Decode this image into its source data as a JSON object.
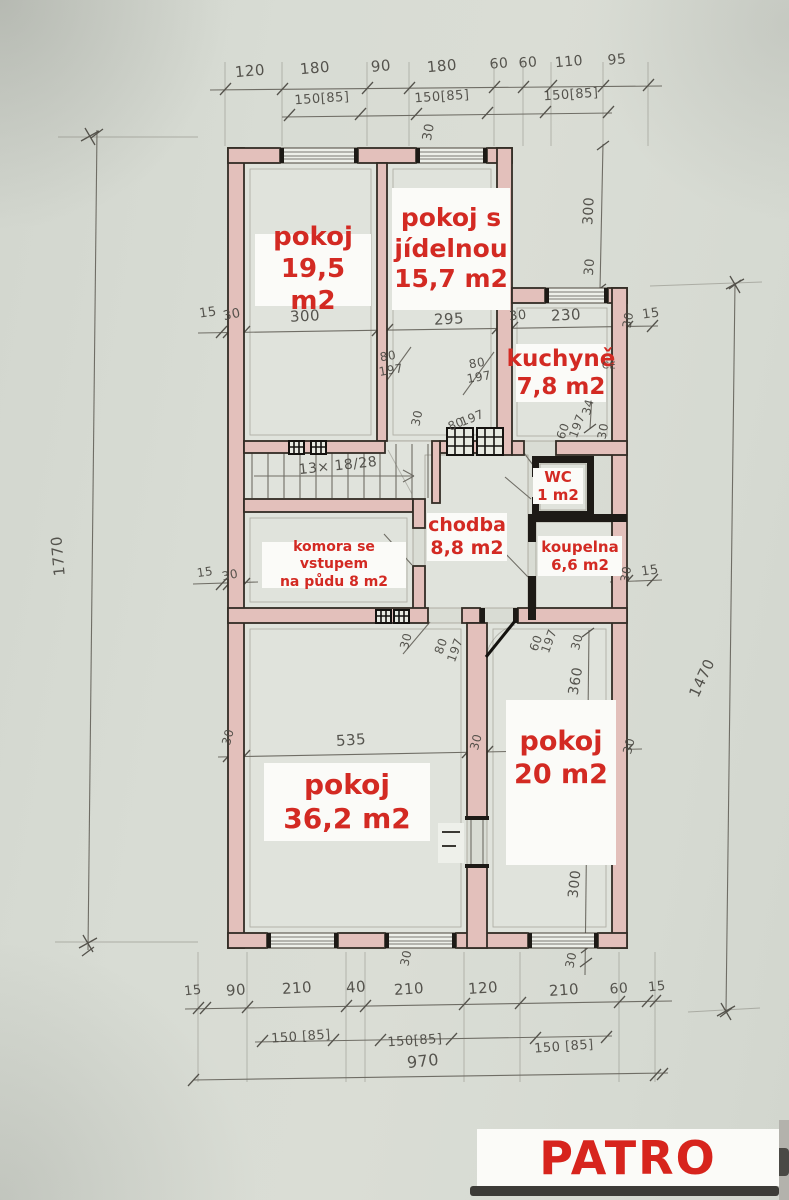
{
  "title": "PATRO",
  "accent_color": "#d32a23",
  "paper_color": "#d6dad2",
  "wall_fill_color": "#e3c0bb",
  "stair_note": "13× 18/28",
  "rooms": [
    {
      "name": "pokoj",
      "area": "19,5 m2",
      "lines": [
        "pokoj",
        "19,5 m2"
      ],
      "box": {
        "x": 255,
        "y": 234,
        "w": 116,
        "h": 72,
        "fs": 26
      }
    },
    {
      "name": "pokoj s jídelnou",
      "area": "15,7 m2",
      "lines": [
        "pokoj s",
        "jídelnou",
        "15,7 m2"
      ],
      "box": {
        "x": 392,
        "y": 188,
        "w": 118,
        "h": 122,
        "fs": 25
      }
    },
    {
      "name": "kuchyně",
      "area": "7,8 m2",
      "lines": [
        "kuchyně",
        "7,8 m2"
      ],
      "box": {
        "x": 516,
        "y": 344,
        "w": 90,
        "h": 58,
        "fs": 23
      }
    },
    {
      "name": "WC",
      "area": "1 m2",
      "lines": [
        "WC",
        "1 m2"
      ],
      "box": {
        "x": 533,
        "y": 468,
        "w": 50,
        "h": 36,
        "fs": 15
      }
    },
    {
      "name": "chodba",
      "area": "8,8 m2",
      "lines": [
        "chodba",
        "8,8 m2"
      ],
      "box": {
        "x": 427,
        "y": 513,
        "w": 80,
        "h": 48,
        "fs": 19
      }
    },
    {
      "name": "komora se vstupem na půdu",
      "area": "8 m2",
      "lines": [
        "komora se vstupem",
        "na půdu  8 m2"
      ],
      "box": {
        "x": 262,
        "y": 542,
        "w": 144,
        "h": 46,
        "fs": 14
      }
    },
    {
      "name": "koupelna",
      "area": "6,6 m2",
      "lines": [
        "koupelna",
        "6,6 m2"
      ],
      "box": {
        "x": 538,
        "y": 536,
        "w": 84,
        "h": 40,
        "fs": 15
      }
    },
    {
      "name": "pokoj",
      "area": "36,2 m2",
      "lines": [
        "pokoj",
        "36,2 m2"
      ],
      "box": {
        "x": 264,
        "y": 763,
        "w": 166,
        "h": 78,
        "fs": 28
      }
    },
    {
      "name": "pokoj",
      "area": "20 m2",
      "lines": [
        "pokoj",
        "20 m2"
      ],
      "box": {
        "x": 506,
        "y": 700,
        "w": 110,
        "h": 165,
        "fs": 27,
        "pt": 26
      }
    }
  ],
  "dimensions": {
    "top_chain": [
      "120",
      "180",
      "90",
      "180",
      "60",
      "60",
      "110",
      "95"
    ],
    "top_windows": [
      "150[85]",
      "150[85]",
      "150[85]"
    ],
    "bottom_chain": [
      "15",
      "90",
      "210",
      "40",
      "210",
      "120",
      "210",
      "60",
      "15"
    ],
    "bottom_windows": [
      "150 [85]",
      "150[85]",
      "150 [85]"
    ],
    "bottom_total": "970",
    "left_total": "1770",
    "right_total": "1470"
  },
  "pencil_annotations": [
    {
      "t": "120",
      "x": 250,
      "y": 71,
      "r": -5,
      "fs": 15
    },
    {
      "t": "180",
      "x": 315,
      "y": 68,
      "r": -5,
      "fs": 15
    },
    {
      "t": "90",
      "x": 381,
      "y": 66,
      "r": -5,
      "fs": 15
    },
    {
      "t": "180",
      "x": 442,
      "y": 66,
      "r": -5,
      "fs": 15
    },
    {
      "t": "60",
      "x": 499,
      "y": 64,
      "r": -5,
      "fs": 14
    },
    {
      "t": "60",
      "x": 528,
      "y": 63,
      "r": -5,
      "fs": 14
    },
    {
      "t": "110",
      "x": 569,
      "y": 62,
      "r": -5,
      "fs": 14
    },
    {
      "t": "95",
      "x": 617,
      "y": 60,
      "r": -5,
      "fs": 14
    },
    {
      "t": "150[85]",
      "x": 322,
      "y": 99,
      "r": -4,
      "fs": 13
    },
    {
      "t": "150[85]",
      "x": 442,
      "y": 97,
      "r": -4,
      "fs": 13
    },
    {
      "t": "150[85]",
      "x": 571,
      "y": 95,
      "r": -4,
      "fs": 13
    },
    {
      "t": "30",
      "x": 429,
      "y": 132,
      "r": -80,
      "fs": 13
    },
    {
      "t": "1770",
      "x": 58,
      "y": 556,
      "r": -95,
      "fs": 15
    },
    {
      "t": "1470",
      "x": 702,
      "y": 678,
      "r": -65,
      "fs": 15
    },
    {
      "t": "300",
      "x": 589,
      "y": 211,
      "r": -87,
      "fs": 14
    },
    {
      "t": "30",
      "x": 590,
      "y": 267,
      "r": -85,
      "fs": 13
    },
    {
      "t": "15",
      "x": 208,
      "y": 313,
      "r": -8,
      "fs": 13
    },
    {
      "t": "30",
      "x": 232,
      "y": 315,
      "r": -12,
      "fs": 13
    },
    {
      "t": "300",
      "x": 305,
      "y": 316,
      "r": -3,
      "fs": 15
    },
    {
      "t": "295",
      "x": 449,
      "y": 319,
      "r": -3,
      "fs": 15
    },
    {
      "t": "30",
      "x": 518,
      "y": 316,
      "r": -6,
      "fs": 13
    },
    {
      "t": "230",
      "x": 566,
      "y": 315,
      "r": -3,
      "fs": 15
    },
    {
      "t": "30",
      "x": 628,
      "y": 320,
      "r": -80,
      "fs": 12
    },
    {
      "t": "15",
      "x": 651,
      "y": 314,
      "r": -8,
      "fs": 13
    },
    {
      "t": "80",
      "x": 388,
      "y": 356,
      "r": -10,
      "fs": 12
    },
    {
      "t": "197",
      "x": 391,
      "y": 370,
      "r": -10,
      "fs": 12
    },
    {
      "t": "80",
      "x": 477,
      "y": 363,
      "r": -10,
      "fs": 12
    },
    {
      "t": "197",
      "x": 479,
      "y": 377,
      "r": -10,
      "fs": 12
    },
    {
      "t": "CE",
      "x": 609,
      "y": 366,
      "r": 0,
      "fs": 10
    },
    {
      "t": "34",
      "x": 588,
      "y": 407,
      "r": -75,
      "fs": 12
    },
    {
      "t": "60",
      "x": 563,
      "y": 431,
      "r": -70,
      "fs": 12
    },
    {
      "t": "197",
      "x": 577,
      "y": 426,
      "r": -70,
      "fs": 12
    },
    {
      "t": "30",
      "x": 603,
      "y": 431,
      "r": -80,
      "fs": 12
    },
    {
      "t": "13× 18/28",
      "x": 338,
      "y": 466,
      "r": -6,
      "fs": 14
    },
    {
      "t": "30",
      "x": 417,
      "y": 418,
      "r": -78,
      "fs": 12
    },
    {
      "t": "80",
      "x": 456,
      "y": 424,
      "r": -22,
      "fs": 12
    },
    {
      "t": "197",
      "x": 472,
      "y": 418,
      "r": -22,
      "fs": 12
    },
    {
      "t": "15",
      "x": 205,
      "y": 572,
      "r": -8,
      "fs": 12
    },
    {
      "t": "30",
      "x": 230,
      "y": 575,
      "r": -12,
      "fs": 12
    },
    {
      "t": "30",
      "x": 626,
      "y": 574,
      "r": -80,
      "fs": 12
    },
    {
      "t": "15",
      "x": 650,
      "y": 571,
      "r": -8,
      "fs": 13
    },
    {
      "t": "30",
      "x": 406,
      "y": 641,
      "r": -75,
      "fs": 12
    },
    {
      "t": "80",
      "x": 441,
      "y": 646,
      "r": -70,
      "fs": 12
    },
    {
      "t": "197",
      "x": 455,
      "y": 650,
      "r": -70,
      "fs": 12
    },
    {
      "t": "60",
      "x": 536,
      "y": 643,
      "r": -70,
      "fs": 12
    },
    {
      "t": "197",
      "x": 549,
      "y": 641,
      "r": -70,
      "fs": 12
    },
    {
      "t": "30",
      "x": 577,
      "y": 642,
      "r": -75,
      "fs": 12
    },
    {
      "t": "360",
      "x": 576,
      "y": 681,
      "r": -80,
      "fs": 14
    },
    {
      "t": "535",
      "x": 351,
      "y": 740,
      "r": -4,
      "fs": 15
    },
    {
      "t": "30",
      "x": 228,
      "y": 737,
      "r": -75,
      "fs": 12
    },
    {
      "t": "30",
      "x": 476,
      "y": 742,
      "r": -75,
      "fs": 12
    },
    {
      "t": "30",
      "x": 629,
      "y": 746,
      "r": -75,
      "fs": 12
    },
    {
      "t": "300",
      "x": 575,
      "y": 884,
      "r": -84,
      "fs": 14
    },
    {
      "t": "30",
      "x": 571,
      "y": 960,
      "r": -78,
      "fs": 12
    },
    {
      "t": "30",
      "x": 406,
      "y": 958,
      "r": -78,
      "fs": 12
    },
    {
      "t": "15",
      "x": 193,
      "y": 991,
      "r": -6,
      "fs": 13
    },
    {
      "t": "90",
      "x": 236,
      "y": 990,
      "r": -4,
      "fs": 15
    },
    {
      "t": "210",
      "x": 297,
      "y": 988,
      "r": -4,
      "fs": 15
    },
    {
      "t": "40",
      "x": 356,
      "y": 987,
      "r": -4,
      "fs": 15
    },
    {
      "t": "210",
      "x": 409,
      "y": 989,
      "r": -4,
      "fs": 15
    },
    {
      "t": "120",
      "x": 483,
      "y": 988,
      "r": -4,
      "fs": 15
    },
    {
      "t": "210",
      "x": 564,
      "y": 990,
      "r": -4,
      "fs": 15
    },
    {
      "t": "60",
      "x": 619,
      "y": 989,
      "r": -4,
      "fs": 14
    },
    {
      "t": "15",
      "x": 657,
      "y": 987,
      "r": -6,
      "fs": 13
    },
    {
      "t": "150 [85]",
      "x": 301,
      "y": 1037,
      "r": -4,
      "fs": 13
    },
    {
      "t": "150[85]",
      "x": 415,
      "y": 1041,
      "r": -4,
      "fs": 13
    },
    {
      "t": "150 [85]",
      "x": 564,
      "y": 1047,
      "r": -4,
      "fs": 13
    },
    {
      "t": "970",
      "x": 423,
      "y": 1061,
      "r": -6,
      "fs": 16
    }
  ]
}
